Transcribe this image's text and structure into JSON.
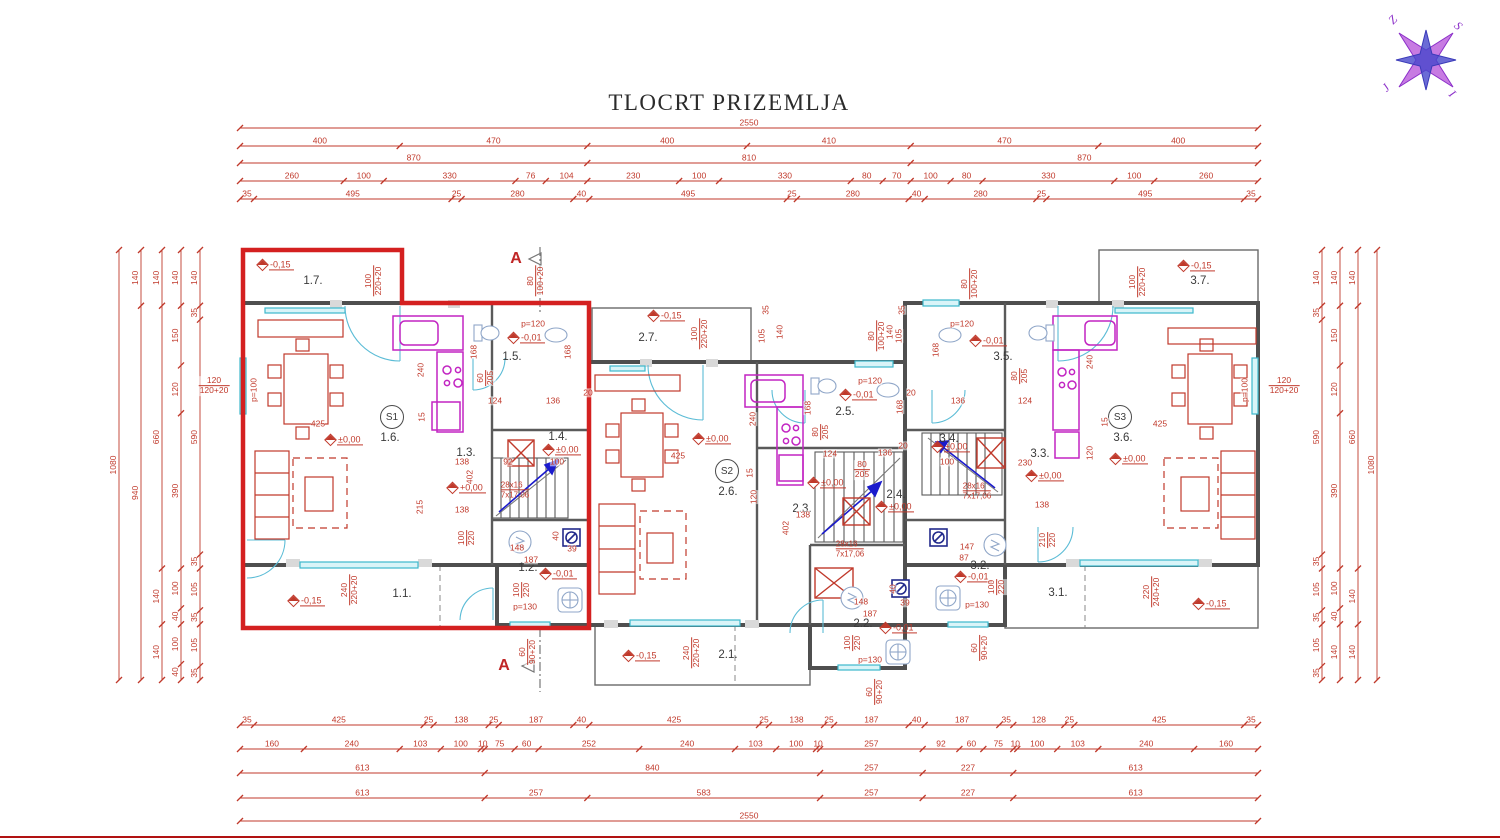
{
  "title": "TLOCRT PRIZEMLJA",
  "colors": {
    "dim_red": "#c0392b",
    "wall_gray": "#4f4f4f",
    "window_cyan": "#3cb8cc",
    "kitchen_magenta": "#c224c2",
    "highlight_red": "#d42020",
    "stair_arrow_blue": "#1a1acc",
    "compass_purple": "#a040d0",
    "compass_blue": "#4040cc",
    "frame_red": "#b11212"
  },
  "compass": {
    "letters": [
      {
        "t": "Z",
        "x": 1393,
        "y": 20
      },
      {
        "t": "S",
        "x": 1458,
        "y": 26
      },
      {
        "t": "J",
        "x": 1386,
        "y": 88
      },
      {
        "t": "I",
        "x": 1452,
        "y": 94
      }
    ]
  },
  "dim_strips": [
    {
      "o": "h",
      "y": 128,
      "a": 240,
      "b": 1258,
      "segs": [
        2550
      ]
    },
    {
      "o": "h",
      "y": 146,
      "a": 240,
      "b": 1258,
      "segs": [
        400,
        470,
        400,
        410,
        470,
        400
      ]
    },
    {
      "o": "h",
      "y": 163,
      "a": 240,
      "b": 1258,
      "segs": [
        870,
        810,
        870
      ]
    },
    {
      "o": "h",
      "y": 181,
      "a": 240,
      "b": 1258,
      "segs": [
        260,
        100,
        330,
        76,
        104,
        230,
        100,
        330,
        80,
        70,
        100,
        80,
        330,
        100,
        260
      ]
    },
    {
      "o": "h",
      "y": 199,
      "a": 240,
      "b": 1258,
      "segs": [
        35,
        495,
        25,
        280,
        40,
        495,
        25,
        280,
        40,
        280,
        25,
        495,
        35
      ]
    },
    {
      "o": "h",
      "y": 725,
      "a": 240,
      "b": 1258,
      "segs": [
        35,
        425,
        25,
        138,
        25,
        187,
        40,
        425,
        25,
        138,
        25,
        187,
        40,
        187,
        35,
        128,
        25,
        425,
        35
      ]
    },
    {
      "o": "h",
      "y": 749,
      "a": 240,
      "b": 1258,
      "segs": [
        160,
        240,
        103,
        100,
        10,
        75,
        60,
        252,
        240,
        103,
        100,
        10,
        257,
        92,
        60,
        75,
        10,
        100,
        103,
        240,
        160
      ]
    },
    {
      "o": "h",
      "y": 773,
      "a": 240,
      "b": 1258,
      "segs": [
        613,
        840,
        257,
        227,
        613
      ]
    },
    {
      "o": "h",
      "y": 798,
      "a": 240,
      "b": 1258,
      "segs": [
        613,
        257,
        583,
        257,
        227,
        613
      ]
    },
    {
      "o": "h",
      "y": 821,
      "a": 240,
      "b": 1258,
      "segs": [
        2550
      ]
    },
    {
      "o": "v",
      "x": 119,
      "a": 250,
      "b": 680,
      "segs": [
        1080
      ]
    },
    {
      "o": "v",
      "x": 141,
      "a": 250,
      "b": 680,
      "segs": [
        140,
        940
      ]
    },
    {
      "o": "v",
      "x": 162,
      "a": 250,
      "b": 680,
      "segs": [
        140,
        660,
        140,
        140
      ]
    },
    {
      "o": "v",
      "x": 181,
      "a": 250,
      "b": 680,
      "segs": [
        140,
        150,
        120,
        390,
        100,
        40,
        100,
        40
      ]
    },
    {
      "o": "v",
      "x": 200,
      "a": 250,
      "b": 680,
      "segs": [
        140,
        35,
        590,
        35,
        105,
        35,
        105,
        35
      ]
    },
    {
      "o": "v",
      "x": 1322,
      "a": 250,
      "b": 680,
      "segs": [
        140,
        35,
        590,
        35,
        105,
        35,
        105,
        35
      ]
    },
    {
      "o": "v",
      "x": 1340,
      "a": 250,
      "b": 680,
      "segs": [
        140,
        150,
        120,
        390,
        100,
        40,
        140
      ]
    },
    {
      "o": "v",
      "x": 1358,
      "a": 250,
      "b": 680,
      "segs": [
        140,
        660,
        140,
        140
      ]
    },
    {
      "o": "v",
      "x": 1377,
      "a": 250,
      "b": 680,
      "segs": [
        1080
      ]
    }
  ],
  "rooms": [
    {
      "t": "1.7.",
      "x": 313,
      "y": 281
    },
    {
      "t": "1.5.",
      "x": 512,
      "y": 357
    },
    {
      "t": "1.6.",
      "x": 390,
      "y": 438
    },
    {
      "t": "1.4.",
      "x": 558,
      "y": 437
    },
    {
      "t": "1.3.",
      "x": 466,
      "y": 453
    },
    {
      "t": "1.2.",
      "x": 528,
      "y": 568
    },
    {
      "t": "1.1.",
      "x": 402,
      "y": 594
    },
    {
      "t": "2.7.",
      "x": 648,
      "y": 338
    },
    {
      "t": "2.5.",
      "x": 845,
      "y": 412
    },
    {
      "t": "2.6.",
      "x": 728,
      "y": 492
    },
    {
      "t": "2.4.",
      "x": 896,
      "y": 495
    },
    {
      "t": "2.3.",
      "x": 802,
      "y": 509
    },
    {
      "t": "2.2.",
      "x": 863,
      "y": 624
    },
    {
      "t": "2.1.",
      "x": 728,
      "y": 655
    },
    {
      "t": "3.7.",
      "x": 1200,
      "y": 281
    },
    {
      "t": "3.5.",
      "x": 1003,
      "y": 357
    },
    {
      "t": "3.6.",
      "x": 1123,
      "y": 438
    },
    {
      "t": "3.4.",
      "x": 949,
      "y": 439
    },
    {
      "t": "3.3.",
      "x": 1040,
      "y": 454
    },
    {
      "t": "3.2.",
      "x": 980,
      "y": 566
    },
    {
      "t": "3.1.",
      "x": 1058,
      "y": 593
    }
  ],
  "badges": [
    {
      "t": "S1",
      "x": 392,
      "y": 417
    },
    {
      "t": "S2",
      "x": 727,
      "y": 471
    },
    {
      "t": "S3",
      "x": 1120,
      "y": 417
    }
  ],
  "elevations": [
    {
      "t": "-0,15",
      "x": 258,
      "y": 266
    },
    {
      "t": "-0,15",
      "x": 649,
      "y": 317
    },
    {
      "t": "-0,15",
      "x": 1179,
      "y": 267
    },
    {
      "t": "-0,15",
      "x": 289,
      "y": 602
    },
    {
      "t": "-0,15",
      "x": 624,
      "y": 657
    },
    {
      "t": "-0,15",
      "x": 1194,
      "y": 605
    },
    {
      "t": "±0,00",
      "x": 326,
      "y": 441
    },
    {
      "t": "±0,00",
      "x": 694,
      "y": 440
    },
    {
      "t": "±0,00",
      "x": 1111,
      "y": 460
    },
    {
      "t": "+0,00",
      "x": 448,
      "y": 489
    },
    {
      "t": "±0,00",
      "x": 544,
      "y": 451
    },
    {
      "t": "±0,00",
      "x": 809,
      "y": 484
    },
    {
      "t": "±0,00",
      "x": 877,
      "y": 508
    },
    {
      "t": "±0,00",
      "x": 933,
      "y": 448
    },
    {
      "t": "±0,00",
      "x": 1027,
      "y": 477
    },
    {
      "t": "-0,01",
      "x": 509,
      "y": 339
    },
    {
      "t": "-0,01",
      "x": 841,
      "y": 396
    },
    {
      "t": "-0,01",
      "x": 971,
      "y": 342
    },
    {
      "t": "-0,01",
      "x": 541,
      "y": 575
    },
    {
      "t": "-0,01",
      "x": 881,
      "y": 629
    },
    {
      "t": "-0,01",
      "x": 956,
      "y": 578
    }
  ],
  "annotations": [
    {
      "t": "100/220+20",
      "x": 374,
      "y": 281,
      "r": 1
    },
    {
      "t": "80/100+20",
      "x": 536,
      "y": 281,
      "r": 1
    },
    {
      "t": "100/220+20",
      "x": 700,
      "y": 334,
      "r": 1
    },
    {
      "t": "80/100+20",
      "x": 877,
      "y": 336,
      "r": 1
    },
    {
      "t": "80/100+20",
      "x": 970,
      "y": 284,
      "r": 1
    },
    {
      "t": "100/220+20",
      "x": 1138,
      "y": 282,
      "r": 1
    },
    {
      "t": "p=120",
      "x": 533,
      "y": 324
    },
    {
      "t": "p=120",
      "x": 870,
      "y": 381
    },
    {
      "t": "p=120",
      "x": 962,
      "y": 324
    },
    {
      "t": "p=100",
      "x": 254,
      "y": 390,
      "r": 1
    },
    {
      "t": "p=100",
      "x": 1245,
      "y": 390,
      "r": 1
    },
    {
      "t": "120/120+20",
      "x": 214,
      "y": 386
    },
    {
      "t": "120/120+20",
      "x": 1284,
      "y": 386
    },
    {
      "t": "168",
      "x": 474,
      "y": 352,
      "r": 1
    },
    {
      "t": "168",
      "x": 568,
      "y": 352,
      "r": 1
    },
    {
      "t": "168",
      "x": 808,
      "y": 408,
      "r": 1
    },
    {
      "t": "168",
      "x": 900,
      "y": 407,
      "r": 1
    },
    {
      "t": "168",
      "x": 936,
      "y": 350,
      "r": 1
    },
    {
      "t": "240",
      "x": 421,
      "y": 370,
      "r": 1
    },
    {
      "t": "240",
      "x": 753,
      "y": 419,
      "r": 1
    },
    {
      "t": "240",
      "x": 1090,
      "y": 362,
      "r": 1
    },
    {
      "t": "60/205",
      "x": 486,
      "y": 378,
      "r": 1
    },
    {
      "t": "80/205",
      "x": 821,
      "y": 432,
      "r": 1
    },
    {
      "t": "80/205",
      "x": 1020,
      "y": 376,
      "r": 1
    },
    {
      "t": "80/205",
      "x": 862,
      "y": 470
    },
    {
      "t": "124",
      "x": 495,
      "y": 401
    },
    {
      "t": "136",
      "x": 553,
      "y": 401
    },
    {
      "t": "124",
      "x": 830,
      "y": 454
    },
    {
      "t": "136",
      "x": 885,
      "y": 453
    },
    {
      "t": "124",
      "x": 1025,
      "y": 401
    },
    {
      "t": "136",
      "x": 958,
      "y": 401
    },
    {
      "t": "20",
      "x": 588,
      "y": 393
    },
    {
      "t": "20",
      "x": 903,
      "y": 446
    },
    {
      "t": "20",
      "x": 911,
      "y": 393
    },
    {
      "t": "425",
      "x": 318,
      "y": 424
    },
    {
      "t": "425",
      "x": 678,
      "y": 456
    },
    {
      "t": "425",
      "x": 1160,
      "y": 424
    },
    {
      "t": "35",
      "x": 766,
      "y": 310,
      "r": 1
    },
    {
      "t": "105",
      "x": 762,
      "y": 336,
      "r": 1
    },
    {
      "t": "140",
      "x": 780,
      "y": 332,
      "r": 1
    },
    {
      "t": "35",
      "x": 902,
      "y": 310,
      "r": 1
    },
    {
      "t": "105",
      "x": 899,
      "y": 336,
      "r": 1
    },
    {
      "t": "140",
      "x": 890,
      "y": 332,
      "r": 1
    },
    {
      "t": "138",
      "x": 462,
      "y": 462
    },
    {
      "t": "138",
      "x": 462,
      "y": 510
    },
    {
      "t": "138",
      "x": 803,
      "y": 515
    },
    {
      "t": "138",
      "x": 1042,
      "y": 505
    },
    {
      "t": "100",
      "x": 557,
      "y": 462
    },
    {
      "t": "100",
      "x": 947,
      "y": 462
    },
    {
      "t": "230",
      "x": 1025,
      "y": 463
    },
    {
      "t": "402",
      "x": 470,
      "y": 477,
      "r": 1
    },
    {
      "t": "402",
      "x": 786,
      "y": 528,
      "r": 1
    },
    {
      "t": "215",
      "x": 420,
      "y": 507,
      "r": 1
    },
    {
      "t": "92",
      "x": 508,
      "y": 462
    },
    {
      "t": "148",
      "x": 517,
      "y": 548
    },
    {
      "t": "187",
      "x": 531,
      "y": 560
    },
    {
      "t": "148",
      "x": 861,
      "y": 602
    },
    {
      "t": "187",
      "x": 870,
      "y": 614
    },
    {
      "t": "147",
      "x": 967,
      "y": 547
    },
    {
      "t": "87",
      "x": 964,
      "y": 558
    },
    {
      "t": "39",
      "x": 572,
      "y": 549
    },
    {
      "t": "39",
      "x": 905,
      "y": 603
    },
    {
      "t": "40",
      "x": 556,
      "y": 536,
      "r": 1
    },
    {
      "t": "40",
      "x": 893,
      "y": 589,
      "r": 1
    },
    {
      "t": "210/220",
      "x": 1048,
      "y": 540,
      "r": 1
    },
    {
      "t": "100/220",
      "x": 467,
      "y": 538,
      "r": 1
    },
    {
      "t": "100/220",
      "x": 522,
      "y": 590,
      "r": 1
    },
    {
      "t": "100/220",
      "x": 853,
      "y": 643,
      "r": 1
    },
    {
      "t": "100/220",
      "x": 997,
      "y": 587,
      "r": 1
    },
    {
      "t": "p=130",
      "x": 525,
      "y": 607
    },
    {
      "t": "p=130",
      "x": 870,
      "y": 660
    },
    {
      "t": "p=130",
      "x": 977,
      "y": 605
    },
    {
      "t": "60/90+20",
      "x": 528,
      "y": 652,
      "r": 1
    },
    {
      "t": "60/90+20",
      "x": 875,
      "y": 692,
      "r": 1
    },
    {
      "t": "60/90+20",
      "x": 980,
      "y": 648,
      "r": 1
    },
    {
      "t": "240/220+20",
      "x": 350,
      "y": 590,
      "r": 1
    },
    {
      "t": "240/220+20",
      "x": 692,
      "y": 653,
      "r": 1
    },
    {
      "t": "220/240+20",
      "x": 1152,
      "y": 592,
      "r": 1
    },
    {
      "t": "15",
      "x": 422,
      "y": 417,
      "r": 1
    },
    {
      "t": "15",
      "x": 750,
      "y": 473,
      "r": 1
    },
    {
      "t": "15",
      "x": 1105,
      "y": 422,
      "r": 1
    },
    {
      "t": "120",
      "x": 754,
      "y": 497,
      "r": 1
    },
    {
      "t": "120",
      "x": 1090,
      "y": 453,
      "r": 1
    }
  ],
  "stairs": {
    "l1": "28x16",
    "l2": "7x17,06",
    "positions": [
      {
        "x": 515,
        "y": 490
      },
      {
        "x": 850,
        "y": 549
      },
      {
        "x": 977,
        "y": 491
      }
    ]
  },
  "sections": {
    "label": "A",
    "positions": [
      {
        "x": 516,
        "y": 259
      },
      {
        "x": 504,
        "y": 666
      }
    ]
  }
}
